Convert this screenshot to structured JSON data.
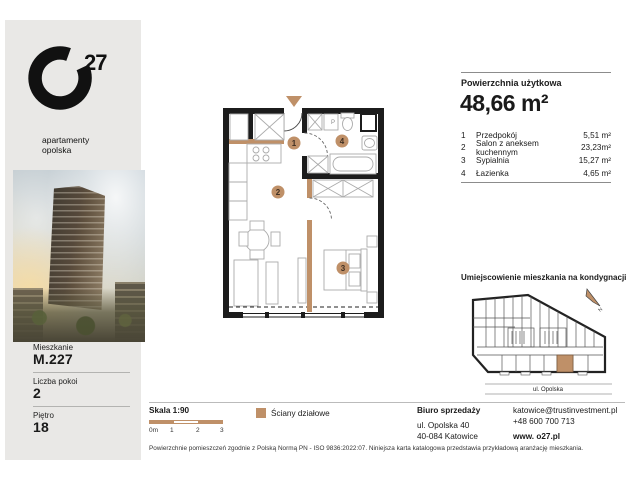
{
  "brand": {
    "logo_number": "27",
    "tagline_line1": "apartamenty",
    "tagline_line2": "opolska"
  },
  "unit": {
    "fields": [
      {
        "label": "Mieszkanie",
        "value": "M.227"
      },
      {
        "label": "Liczba pokoi",
        "value": "2"
      },
      {
        "label": "Piętro",
        "value": "18"
      }
    ]
  },
  "summary": {
    "label": "Powierzchnia użytkowa",
    "value": "48,66 m²"
  },
  "rooms": [
    {
      "no": "1",
      "name": "Przedpokój",
      "area": "5,51 m²"
    },
    {
      "no": "2",
      "name": "Salon z aneksem kuchennym",
      "area": "23,23m²"
    },
    {
      "no": "3",
      "name": "Sypialnia",
      "area": "15,27 m²"
    },
    {
      "no": "4",
      "name": "Łazienka",
      "area": "4,65 m²"
    }
  ],
  "location": {
    "title": "Umiejscowienie mieszkania na kondygnacji",
    "street": "ul. Opolska",
    "north_label": "N"
  },
  "plan": {
    "appliance_label": "P"
  },
  "footer": {
    "scale_label": "Skala 1:90",
    "scale_ticks": [
      "0m",
      "1",
      "2",
      "3"
    ],
    "legend_label": "Ściany działowe",
    "office": {
      "title": "Biuro sprzedaży",
      "address1": "ul. Opolska 40",
      "address2": "40-084 Katowice"
    },
    "contact": {
      "email": "katowice@trustinvestment.pl",
      "phone": "+48 600 700 713",
      "website": "www. o27.pl"
    },
    "disclaimer": "Powierzchnie pomieszczeń zgodnie z Polską Normą PN - ISO 9836:2022:07. Niniejsza karta katalogowa przedstawia przykładową aranżację mieszkania."
  },
  "colors": {
    "accent": "#bf9068",
    "wall": "#1c1c1c",
    "sidebar_bg": "#e9e8e6"
  }
}
